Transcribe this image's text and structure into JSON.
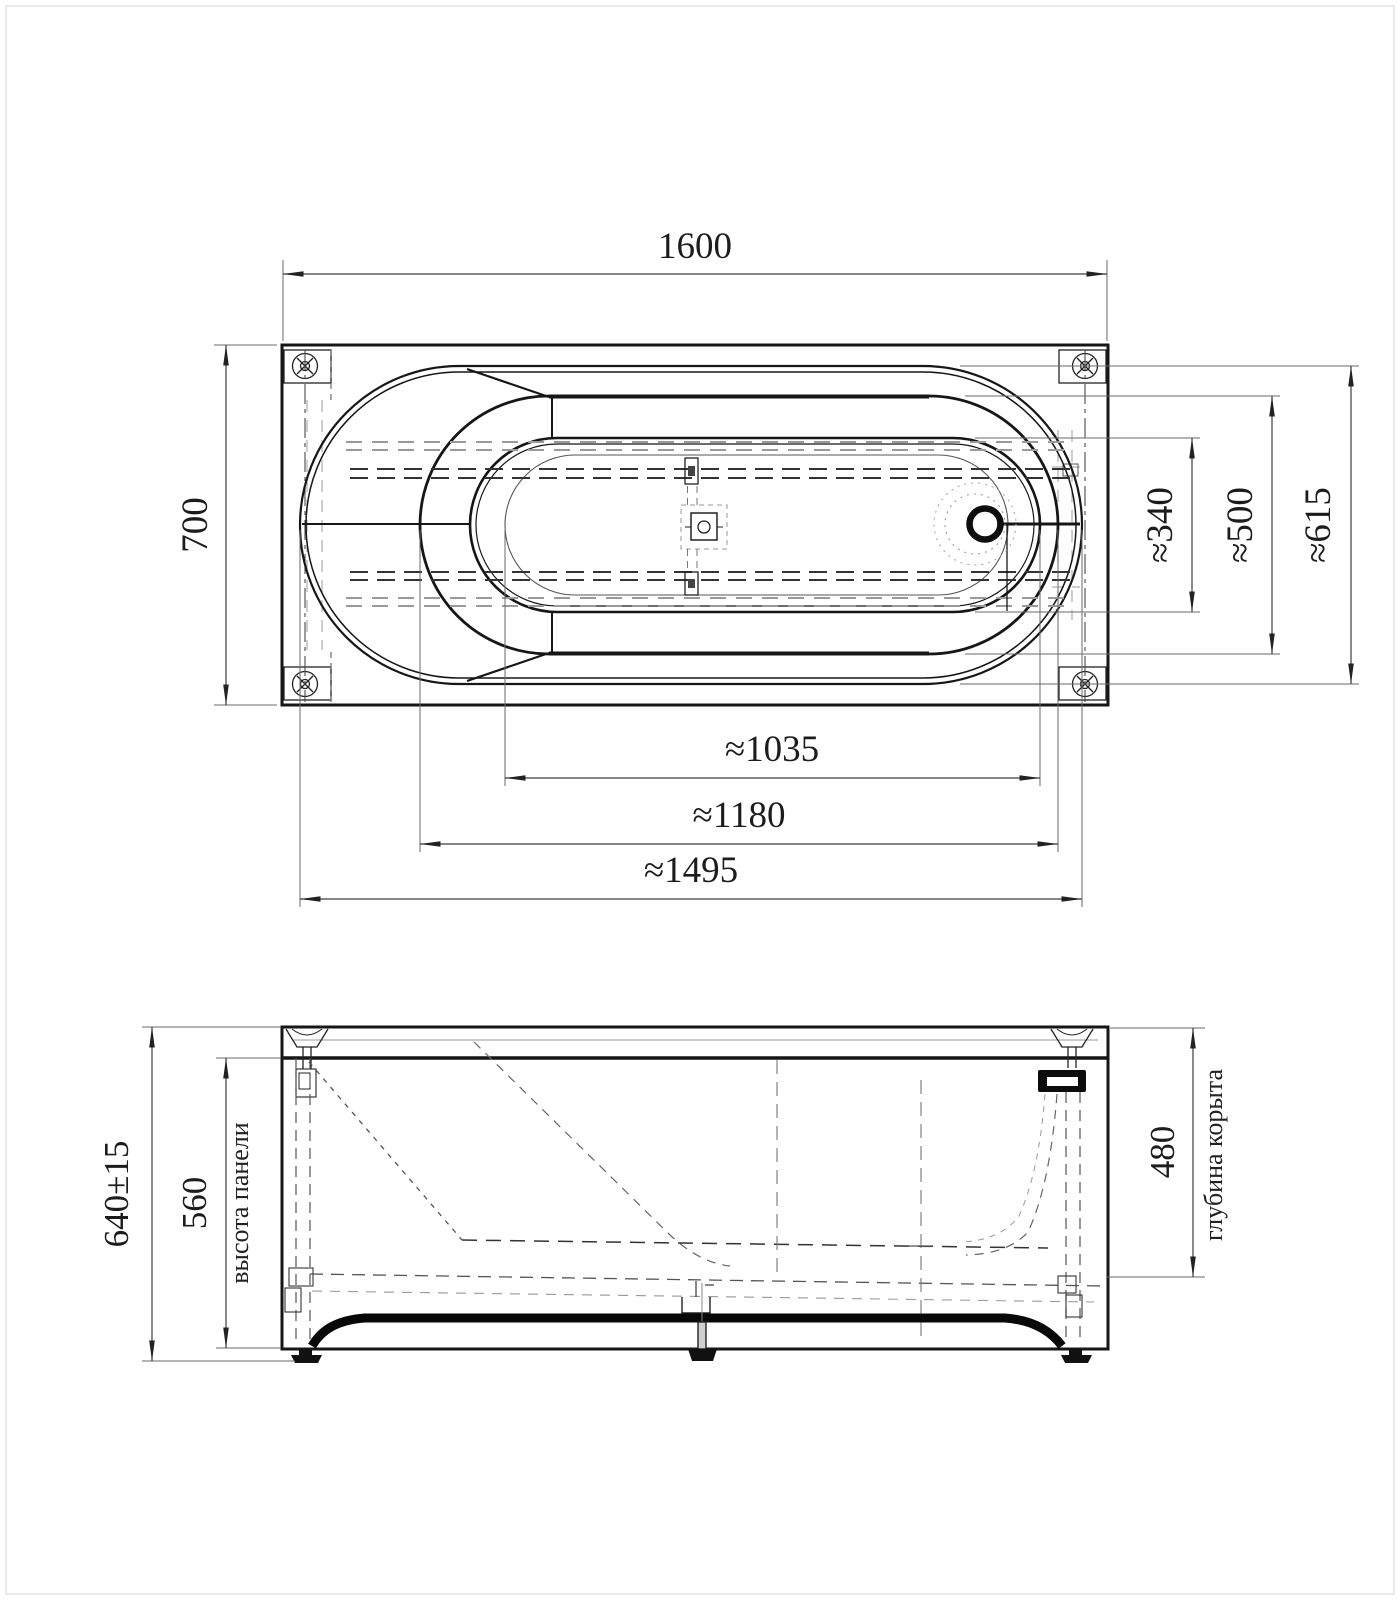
{
  "colors": {
    "line": "#161616",
    "dimension": "#3d3d3d",
    "hidden": "#8c8c8c",
    "background": "#ffffff"
  },
  "views": {
    "plan": {
      "dims": {
        "length": "1600",
        "width": "700",
        "bottom_width": "≈340",
        "opening_width": "≈500",
        "rim_width": "≈615",
        "opening_length": "≈1035",
        "shelf_length": "≈1180",
        "overall_length": "≈1495"
      }
    },
    "front": {
      "dims": {
        "overall_height": "640±15",
        "panel_height": "560",
        "bowl_depth": "480"
      },
      "labels": {
        "panel_height": "высота панели",
        "bowl_depth": "глубина корыта"
      }
    }
  }
}
